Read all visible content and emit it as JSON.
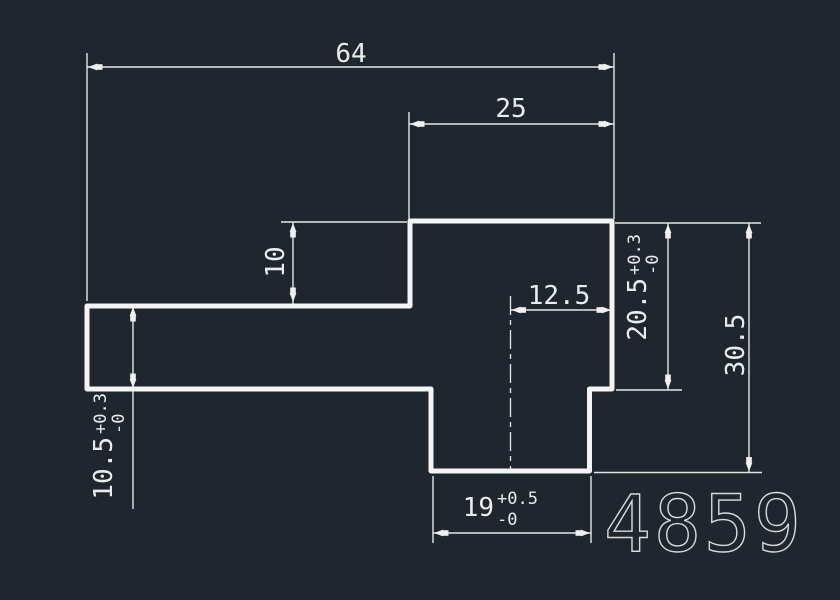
{
  "canvas": {
    "background_color": "#20262e",
    "geometry_line_color": "#f4f4f4",
    "dimension_line_color": "#e6e6e6"
  },
  "drawing": {
    "part_number": "4859",
    "dimensions": {
      "total_width": {
        "value": "64"
      },
      "top_width": {
        "value": "25"
      },
      "step_depth": {
        "value": "10"
      },
      "right_offset": {
        "value": "12.5"
      },
      "right_height": {
        "value": "20.5",
        "tol_plus": "+0.3",
        "tol_minus": "-0"
      },
      "overall_height": {
        "value": "30.5"
      },
      "arm_height": {
        "value": "10.5",
        "tol_plus": "+0.3",
        "tol_minus": "-0"
      },
      "tab_width": {
        "value": "19",
        "tol_plus": "+0.5",
        "tol_minus": "-0"
      }
    }
  }
}
